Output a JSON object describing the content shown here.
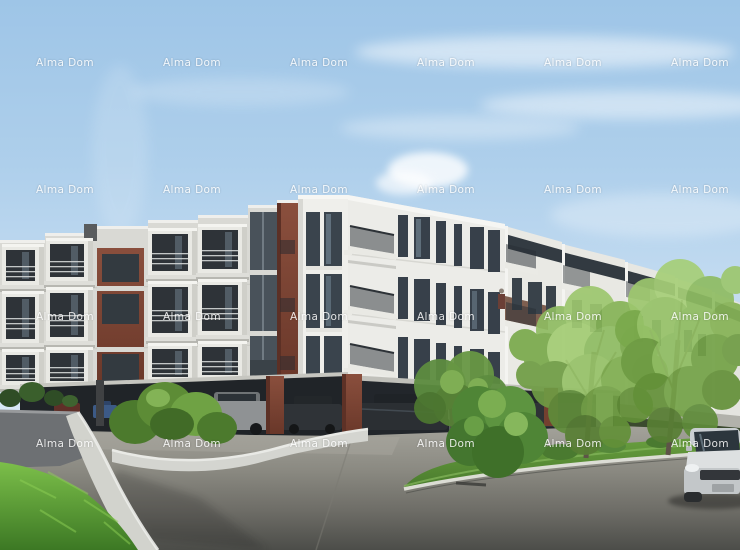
{
  "watermark": {
    "label": "Alma Dom",
    "rows": 4,
    "cols": 6,
    "color": "#ffffff",
    "opacity": 0.85
  },
  "scene": {
    "type": "architectural-rendering",
    "subject": "Modern four-storey apartment complex with white balcony boxes and rust-red accents, open ground-floor parking garage with cars, concrete walls, lawns, shrubs and trees under a blue sky"
  },
  "palette": {
    "sky_top": "#9ec5e7",
    "sky_horizon": "#d6e7f5",
    "facade_white": "#ecece8",
    "facade_shaded": "#d9d9d4",
    "accent_rust": "#7b4334",
    "window_glass": "#39424a",
    "garage_shadow": "#202428",
    "pavement_light": "#a09f97",
    "pavement_dark": "#4d4e4a",
    "grass_bright": "#72b644",
    "tree_foliage": "#9cc76e"
  }
}
